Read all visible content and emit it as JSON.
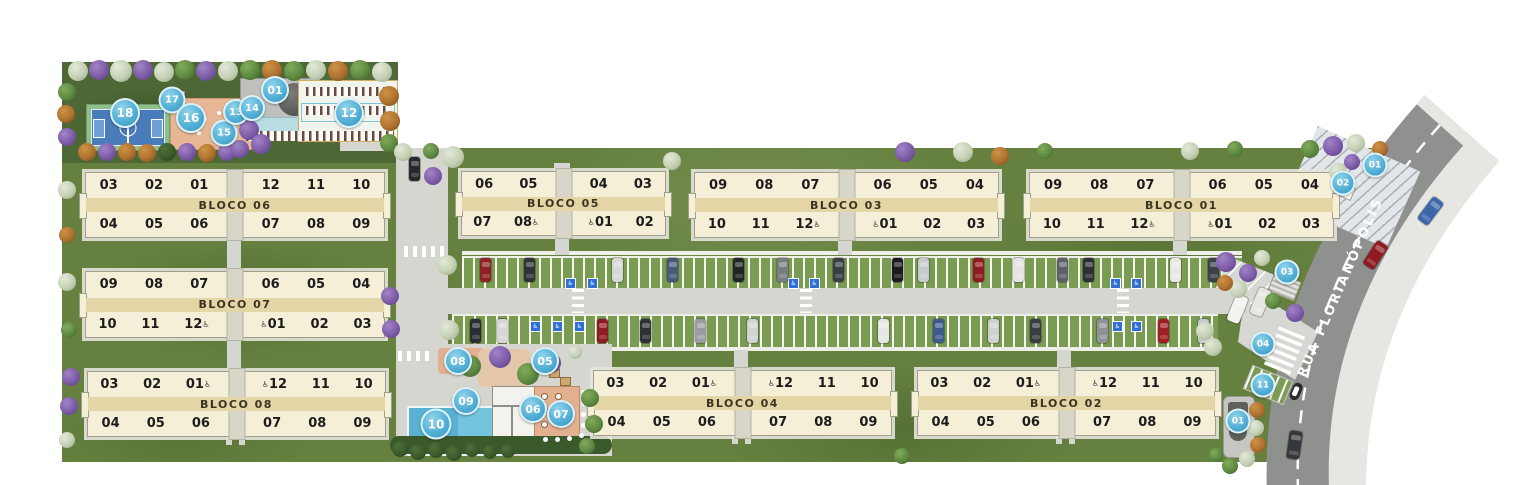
{
  "street": {
    "name": "RUA FLORIANÓPOLIS"
  },
  "colors": {
    "marker_blue": "#55b0d6",
    "grass": "#66813f",
    "grass_dark": "#4d6834",
    "building": "#f5efd8",
    "band": "#e4d5a6",
    "road": "#8f918f",
    "sidewalk": "#e6e6e2",
    "pool": "#58b1d2",
    "accessible_blue": "#2f6fd6"
  },
  "blocks": [
    {
      "label": "BLOCO 06",
      "x": 85,
      "y": 172,
      "w": 298,
      "h": 64,
      "top": [
        "03",
        "02",
        "01",
        "12",
        "11",
        "10"
      ],
      "bottom": [
        "04",
        "05",
        "06",
        "07",
        "08",
        "09"
      ]
    },
    {
      "label": "BLOCO 05",
      "x": 461,
      "y": 171,
      "w": 203,
      "h": 63,
      "top": [
        "06",
        "05",
        "04",
        "03"
      ],
      "bottom": [
        "07",
        "08♿",
        "♿01",
        "02"
      ]
    },
    {
      "label": "BLOCO 03",
      "x": 694,
      "y": 172,
      "w": 303,
      "h": 64,
      "top": [
        "09",
        "08",
        "07",
        "06",
        "05",
        "04"
      ],
      "bottom": [
        "10",
        "11",
        "12♿",
        "♿01",
        "02",
        "03"
      ]
    },
    {
      "label": "BLOCO 01",
      "x": 1029,
      "y": 172,
      "w": 303,
      "h": 64,
      "top": [
        "09",
        "08",
        "07",
        "06",
        "05",
        "04"
      ],
      "bottom": [
        "10",
        "11",
        "12♿",
        "♿01",
        "02",
        "03"
      ]
    },
    {
      "label": "BLOCO 07",
      "x": 85,
      "y": 271,
      "w": 298,
      "h": 65,
      "top": [
        "09",
        "08",
        "07",
        "06",
        "05",
        "04"
      ],
      "bottom": [
        "10",
        "11",
        "12♿",
        "♿01",
        "02",
        "03"
      ]
    },
    {
      "label": "BLOCO 08",
      "x": 87,
      "y": 371,
      "w": 297,
      "h": 64,
      "top": [
        "03",
        "02",
        "01♿",
        "♿12",
        "11",
        "10"
      ],
      "bottom": [
        "04",
        "05",
        "06",
        "07",
        "08",
        "09"
      ]
    },
    {
      "label": "BLOCO 04",
      "x": 593,
      "y": 370,
      "w": 297,
      "h": 64,
      "top": [
        "03",
        "02",
        "01♿",
        "♿12",
        "11",
        "10"
      ],
      "bottom": [
        "04",
        "05",
        "06",
        "07",
        "08",
        "09"
      ]
    },
    {
      "label": "BLOCO 02",
      "x": 917,
      "y": 370,
      "w": 297,
      "h": 64,
      "top": [
        "03",
        "02",
        "01♿",
        "♿12",
        "11",
        "10"
      ],
      "bottom": [
        "04",
        "05",
        "06",
        "07",
        "08",
        "09"
      ]
    }
  ],
  "markers": [
    {
      "n": "18",
      "x": 125,
      "y": 113,
      "s": 26
    },
    {
      "n": "17",
      "x": 172,
      "y": 100,
      "s": 23
    },
    {
      "n": "16",
      "x": 191,
      "y": 118,
      "s": 26
    },
    {
      "n": "15",
      "x": 224,
      "y": 133,
      "s": 23
    },
    {
      "n": "13",
      "x": 236,
      "y": 112,
      "s": 22
    },
    {
      "n": "14",
      "x": 252,
      "y": 108,
      "s": 22
    },
    {
      "n": "01",
      "x": 275,
      "y": 90,
      "s": 24
    },
    {
      "n": "12",
      "x": 349,
      "y": 113,
      "s": 26
    },
    {
      "n": "08",
      "x": 458,
      "y": 361,
      "s": 24
    },
    {
      "n": "05",
      "x": 545,
      "y": 361,
      "s": 24
    },
    {
      "n": "09",
      "x": 466,
      "y": 401,
      "s": 24
    },
    {
      "n": "10",
      "x": 436,
      "y": 424,
      "s": 27
    },
    {
      "n": "06",
      "x": 533,
      "y": 409,
      "s": 24
    },
    {
      "n": "07",
      "x": 561,
      "y": 414,
      "s": 24
    },
    {
      "n": "01",
      "x": 1375,
      "y": 165,
      "s": 21
    },
    {
      "n": "02",
      "x": 1343,
      "y": 183,
      "s": 21
    },
    {
      "n": "03",
      "x": 1287,
      "y": 272,
      "s": 21
    },
    {
      "n": "04",
      "x": 1263,
      "y": 344,
      "s": 21
    },
    {
      "n": "11",
      "x": 1263,
      "y": 385,
      "s": 21
    },
    {
      "n": "01",
      "x": 1238,
      "y": 421,
      "s": 21
    }
  ],
  "decor": {
    "trees": [
      [
        78,
        71,
        10,
        "w"
      ],
      [
        99,
        70,
        10,
        "p"
      ],
      [
        121,
        71,
        11,
        "w"
      ],
      [
        143,
        70,
        10,
        "p"
      ],
      [
        164,
        72,
        10,
        "w"
      ],
      [
        185,
        70,
        10,
        "g"
      ],
      [
        206,
        71,
        10,
        "p"
      ],
      [
        228,
        71,
        10,
        "w"
      ],
      [
        250,
        70,
        10,
        "g"
      ],
      [
        272,
        70,
        10,
        "o"
      ],
      [
        294,
        71,
        10,
        "g"
      ],
      [
        316,
        70,
        10,
        "w"
      ],
      [
        338,
        71,
        10,
        "o"
      ],
      [
        360,
        70,
        10,
        "g"
      ],
      [
        382,
        72,
        10,
        "w"
      ],
      [
        67,
        92,
        9,
        "g"
      ],
      [
        66,
        114,
        9,
        "o"
      ],
      [
        67,
        137,
        9,
        "p"
      ],
      [
        87,
        152,
        9,
        "o"
      ],
      [
        107,
        152,
        9,
        "p"
      ],
      [
        127,
        152,
        9,
        "o"
      ],
      [
        147,
        153,
        9,
        "o"
      ],
      [
        167,
        152,
        9,
        "d"
      ],
      [
        187,
        152,
        9,
        "p"
      ],
      [
        207,
        153,
        9,
        "o"
      ],
      [
        227,
        152,
        9,
        "p"
      ],
      [
        249,
        130,
        10,
        "p"
      ],
      [
        261,
        144,
        10,
        "p"
      ],
      [
        240,
        149,
        9,
        "p"
      ],
      [
        389,
        96,
        10,
        "o"
      ],
      [
        390,
        121,
        10,
        "o"
      ],
      [
        389,
        143,
        9,
        "g"
      ],
      [
        403,
        152,
        9,
        "w"
      ],
      [
        431,
        151,
        8,
        "g"
      ],
      [
        453,
        157,
        11,
        "w"
      ],
      [
        433,
        176,
        9,
        "p"
      ],
      [
        447,
        265,
        10,
        "w"
      ],
      [
        449,
        330,
        10,
        "w"
      ],
      [
        672,
        161,
        9,
        "w"
      ],
      [
        905,
        152,
        10,
        "p"
      ],
      [
        963,
        152,
        10,
        "w"
      ],
      [
        1000,
        156,
        9,
        "o"
      ],
      [
        1045,
        151,
        8,
        "g"
      ],
      [
        1190,
        151,
        9,
        "w"
      ],
      [
        1235,
        149,
        8,
        "g"
      ],
      [
        1310,
        149,
        9,
        "g"
      ],
      [
        1333,
        146,
        10,
        "p"
      ],
      [
        1356,
        143,
        9,
        "w"
      ],
      [
        1380,
        149,
        8,
        "o"
      ],
      [
        1338,
        172,
        9,
        "w"
      ],
      [
        1352,
        162,
        8,
        "p"
      ],
      [
        67,
        190,
        9,
        "w"
      ],
      [
        67,
        235,
        8,
        "o"
      ],
      [
        67,
        282,
        9,
        "w"
      ],
      [
        69,
        330,
        8,
        "g"
      ],
      [
        71,
        377,
        9,
        "p"
      ],
      [
        69,
        406,
        9,
        "p"
      ],
      [
        67,
        440,
        8,
        "w"
      ],
      [
        390,
        296,
        9,
        "p"
      ],
      [
        391,
        329,
        9,
        "p"
      ],
      [
        1226,
        262,
        10,
        "p"
      ],
      [
        1248,
        273,
        9,
        "p"
      ],
      [
        1238,
        289,
        9,
        "w"
      ],
      [
        1262,
        258,
        8,
        "w"
      ],
      [
        1225,
        283,
        8,
        "o"
      ],
      [
        1295,
        313,
        9,
        "p"
      ],
      [
        1273,
        301,
        8,
        "g"
      ],
      [
        1205,
        331,
        9,
        "w"
      ],
      [
        1213,
        347,
        9,
        "w"
      ],
      [
        1257,
        410,
        8,
        "o"
      ],
      [
        1256,
        428,
        8,
        "w"
      ],
      [
        1258,
        445,
        8,
        "o"
      ],
      [
        1247,
        459,
        8,
        "w"
      ],
      [
        1230,
        466,
        8,
        "g"
      ],
      [
        1216,
        455,
        7,
        "g"
      ],
      [
        470,
        366,
        11,
        "g"
      ],
      [
        500,
        357,
        11,
        "p"
      ],
      [
        528,
        374,
        11,
        "g"
      ],
      [
        551,
        363,
        10,
        "p"
      ],
      [
        575,
        352,
        7,
        "w"
      ],
      [
        590,
        398,
        9,
        "g"
      ],
      [
        594,
        424,
        9,
        "g"
      ],
      [
        587,
        446,
        8,
        "g"
      ],
      [
        902,
        456,
        8,
        "g"
      ],
      [
        400,
        449,
        8,
        "d"
      ],
      [
        418,
        452,
        8,
        "d"
      ],
      [
        436,
        450,
        8,
        "d"
      ],
      [
        454,
        453,
        8,
        "d"
      ],
      [
        472,
        450,
        7,
        "d"
      ],
      [
        490,
        452,
        7,
        "d"
      ],
      [
        508,
        451,
        7,
        "d"
      ]
    ],
    "cars": [
      [
        409,
        157,
        "#26282b"
      ],
      [
        480,
        258,
        "#8e2026"
      ],
      [
        524,
        258,
        "#303236"
      ],
      [
        612,
        258,
        "#d6d8d8"
      ],
      [
        667,
        258,
        "#45597a"
      ],
      [
        733,
        258,
        "#222528"
      ],
      [
        777,
        258,
        "#787d82"
      ],
      [
        833,
        258,
        "#3a3f45"
      ],
      [
        892,
        258,
        "#1a1b1e"
      ],
      [
        918,
        258,
        "#c8cbcd"
      ],
      [
        973,
        258,
        "#8e1b22"
      ],
      [
        1013,
        258,
        "#e4e4e2"
      ],
      [
        1057,
        258,
        "#5c6167"
      ],
      [
        1083,
        258,
        "#2c2f33"
      ],
      [
        1170,
        258,
        "#e8e8e6"
      ],
      [
        1208,
        258,
        "#3d4147"
      ],
      [
        470,
        319,
        "#2a2d31"
      ],
      [
        497,
        319,
        "#d5d7d7"
      ],
      [
        597,
        319,
        "#8e1b22"
      ],
      [
        640,
        319,
        "#2d3034"
      ],
      [
        695,
        319,
        "#999da1"
      ],
      [
        747,
        319,
        "#d1d3d3"
      ],
      [
        878,
        319,
        "#e7e7e5"
      ],
      [
        933,
        319,
        "#3d5a8c"
      ],
      [
        988,
        319,
        "#ced1d2"
      ],
      [
        1030,
        319,
        "#393c40"
      ],
      [
        1097,
        319,
        "#8e9397"
      ],
      [
        1158,
        319,
        "#a01d22"
      ],
      [
        1198,
        319,
        "#c7cacb"
      ]
    ],
    "road_cars": [
      [
        1424,
        197,
        "#3a66a8",
        37
      ],
      [
        1369,
        241,
        "#8e1b22",
        33
      ],
      [
        1288,
        431,
        "#35383b",
        8
      ],
      [
        1231,
        295,
        "#f2f2f0",
        22
      ],
      [
        1254,
        288,
        "#e6e6e3",
        22
      ]
    ],
    "accessible_spots": [
      [
        565,
        278
      ],
      [
        587,
        278
      ],
      [
        788,
        278
      ],
      [
        809,
        278
      ],
      [
        1110,
        278
      ],
      [
        1131,
        278
      ],
      [
        530,
        321
      ],
      [
        552,
        321
      ],
      [
        574,
        321
      ],
      [
        596,
        321
      ],
      [
        1112,
        321
      ],
      [
        1131,
        321
      ]
    ],
    "crosswalks": [
      [
        572,
        289,
        12,
        24,
        "h"
      ],
      [
        800,
        289,
        12,
        24,
        "h"
      ],
      [
        1117,
        289,
        12,
        24,
        "h"
      ],
      [
        404,
        246,
        40,
        11,
        "v"
      ],
      [
        398,
        351,
        34,
        10,
        "v"
      ]
    ],
    "pads": [
      [
        396,
        148,
        52,
        208
      ],
      [
        446,
        288,
        802,
        26
      ],
      [
        396,
        344,
        216,
        112
      ],
      [
        227,
        236,
        14,
        36
      ],
      [
        227,
        336,
        14,
        36
      ],
      [
        555,
        235,
        14,
        20
      ],
      [
        838,
        235,
        14,
        20
      ],
      [
        1173,
        235,
        14,
        20
      ],
      [
        734,
        350,
        14,
        21
      ],
      [
        1057,
        350,
        14,
        21
      ],
      [
        226,
        436,
        6,
        9
      ],
      [
        239,
        436,
        6,
        9
      ],
      [
        732,
        435,
        6,
        9
      ],
      [
        745,
        435,
        6,
        9
      ],
      [
        1056,
        435,
        6,
        9
      ],
      [
        1069,
        435,
        6,
        9
      ],
      [
        554,
        163,
        16,
        9
      ],
      [
        340,
        139,
        58,
        12
      ]
    ]
  }
}
